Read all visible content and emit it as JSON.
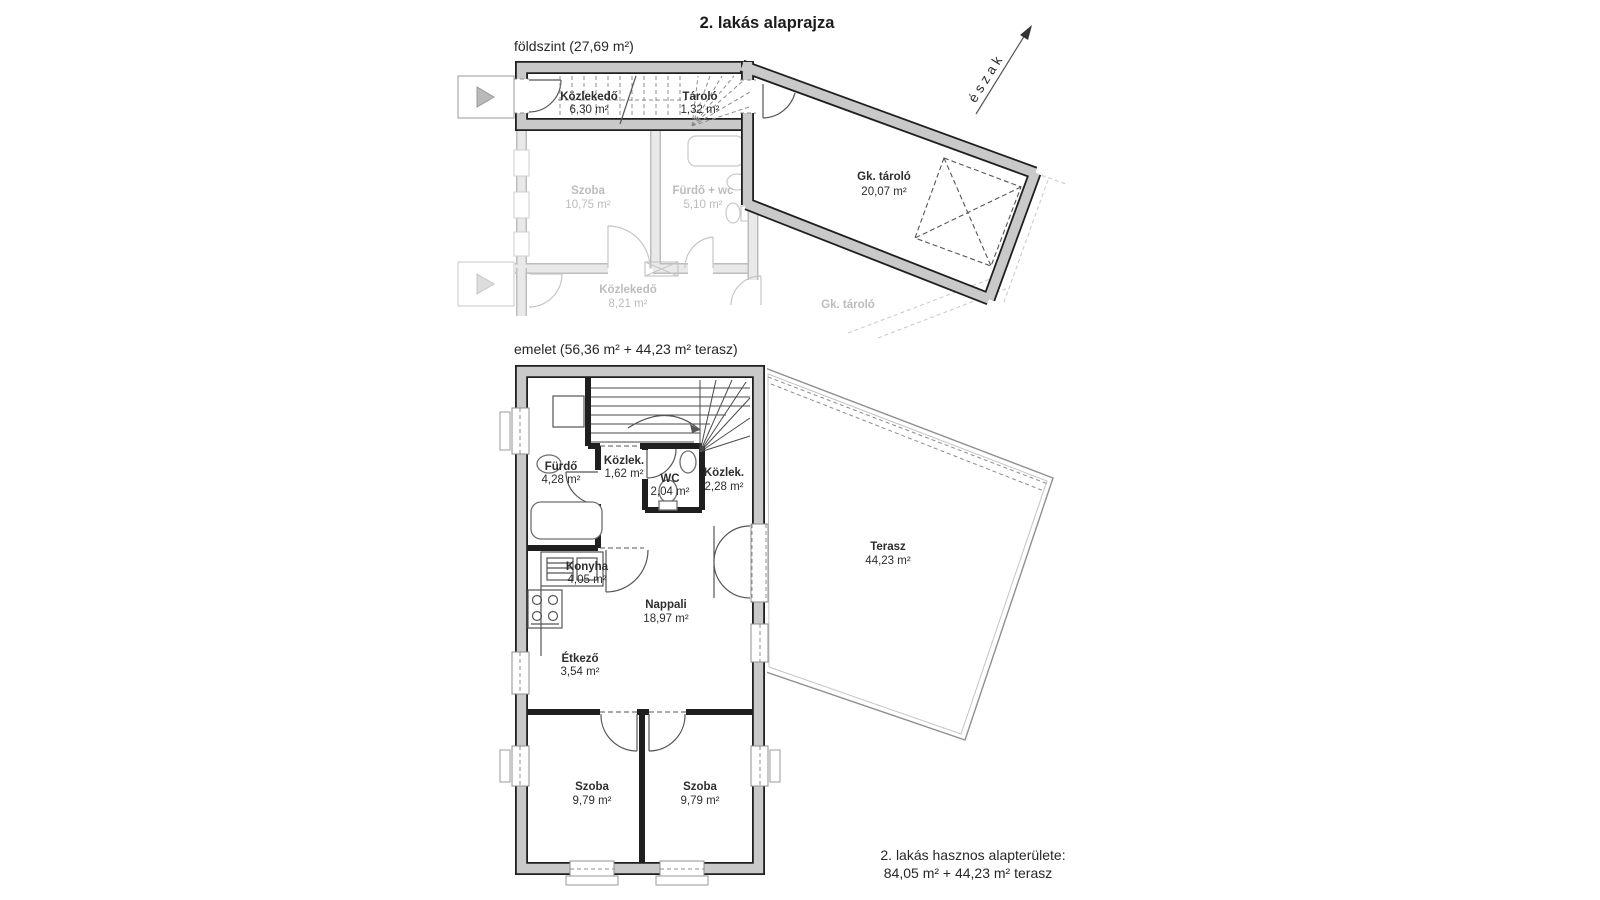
{
  "title": "2. lakás alaprajza",
  "north_label": "észak",
  "ground_floor": {
    "label": "földszint (27,69 m²)",
    "rooms": {
      "kozlekedo": {
        "name": "Közlekedő",
        "area": "6,30 m²"
      },
      "tarolo": {
        "name": "Tároló",
        "area": "1,32 m²"
      },
      "gk_tarolo": {
        "name": "Gk. tároló",
        "area": "20,07 m²"
      },
      "szoba": {
        "name": "Szoba",
        "area": "10,75 m²"
      },
      "furdo_wc": {
        "name": "Fürdő + wc",
        "area": "5,10 m²"
      },
      "kozlekedo2": {
        "name": "Közlekedő",
        "area": "8,21 m²"
      },
      "gk_tarolo_neighbor": {
        "name": "Gk. tároló"
      }
    }
  },
  "upper_floor": {
    "label": "emelet (56,36 m² + 44,23 m² terasz)",
    "rooms": {
      "furdo": {
        "name": "Fürdő",
        "area": "4,28 m²"
      },
      "kozlek1": {
        "name": "Közlek.",
        "area": "1,62 m²"
      },
      "wc": {
        "name": "WC",
        "area": "2,04 m²"
      },
      "kozlek2": {
        "name": "Közlek.",
        "area": "2,28 m²"
      },
      "konyha": {
        "name": "Konyha",
        "area": "4,05 m²"
      },
      "nappali": {
        "name": "Nappali",
        "area": "18,97 m²"
      },
      "etkezo": {
        "name": "Étkező",
        "area": "3,54 m²"
      },
      "terasz": {
        "name": "Terasz",
        "area": "44,23 m²"
      },
      "szoba1": {
        "name": "Szoba",
        "area": "9,79 m²"
      },
      "szoba2": {
        "name": "Szoba",
        "area": "9,79 m²"
      }
    }
  },
  "summary": {
    "line1": "2. lakás hasznos alapterülete:",
    "line2": "84,05 m² + 44,23 m² terasz"
  }
}
